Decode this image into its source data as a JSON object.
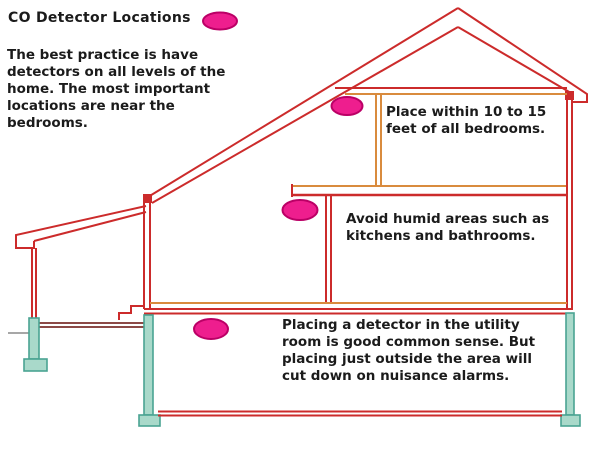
{
  "title": {
    "text": "CO Detector Locations"
  },
  "intro": {
    "lines": [
      "The best practice is have",
      "detectors on all levels of the",
      "home. The most important",
      "locations are near the",
      "bedrooms."
    ]
  },
  "notes": {
    "attic": {
      "lines": [
        "Place within 10 to 15",
        "feet of all bedrooms."
      ]
    },
    "main_level": {
      "lines": [
        "Avoid humid areas such as",
        "kitchens and bathrooms."
      ]
    },
    "basement": {
      "lines": [
        "Placing a detector in the utility",
        "room is good common sense. But",
        "placing just outside the area will",
        "cut down on nuisance alarms."
      ]
    }
  },
  "icons": {
    "detector_marker": "pink-oval"
  },
  "colors": {
    "page_bg": "#ffffff",
    "text_black": "#1b1b1b",
    "wall_red": "#cc2b2b",
    "floor_tan": "#d98b3e",
    "garage_floor_maroon": "#7c2f2b",
    "foundation_teal_fill": "#a9d9ca",
    "foundation_teal_stroke": "#4aa392",
    "grade_grey": "#8a8a8a",
    "marker_pink": "#ee1e8e",
    "marker_outline": "#bb0066"
  }
}
